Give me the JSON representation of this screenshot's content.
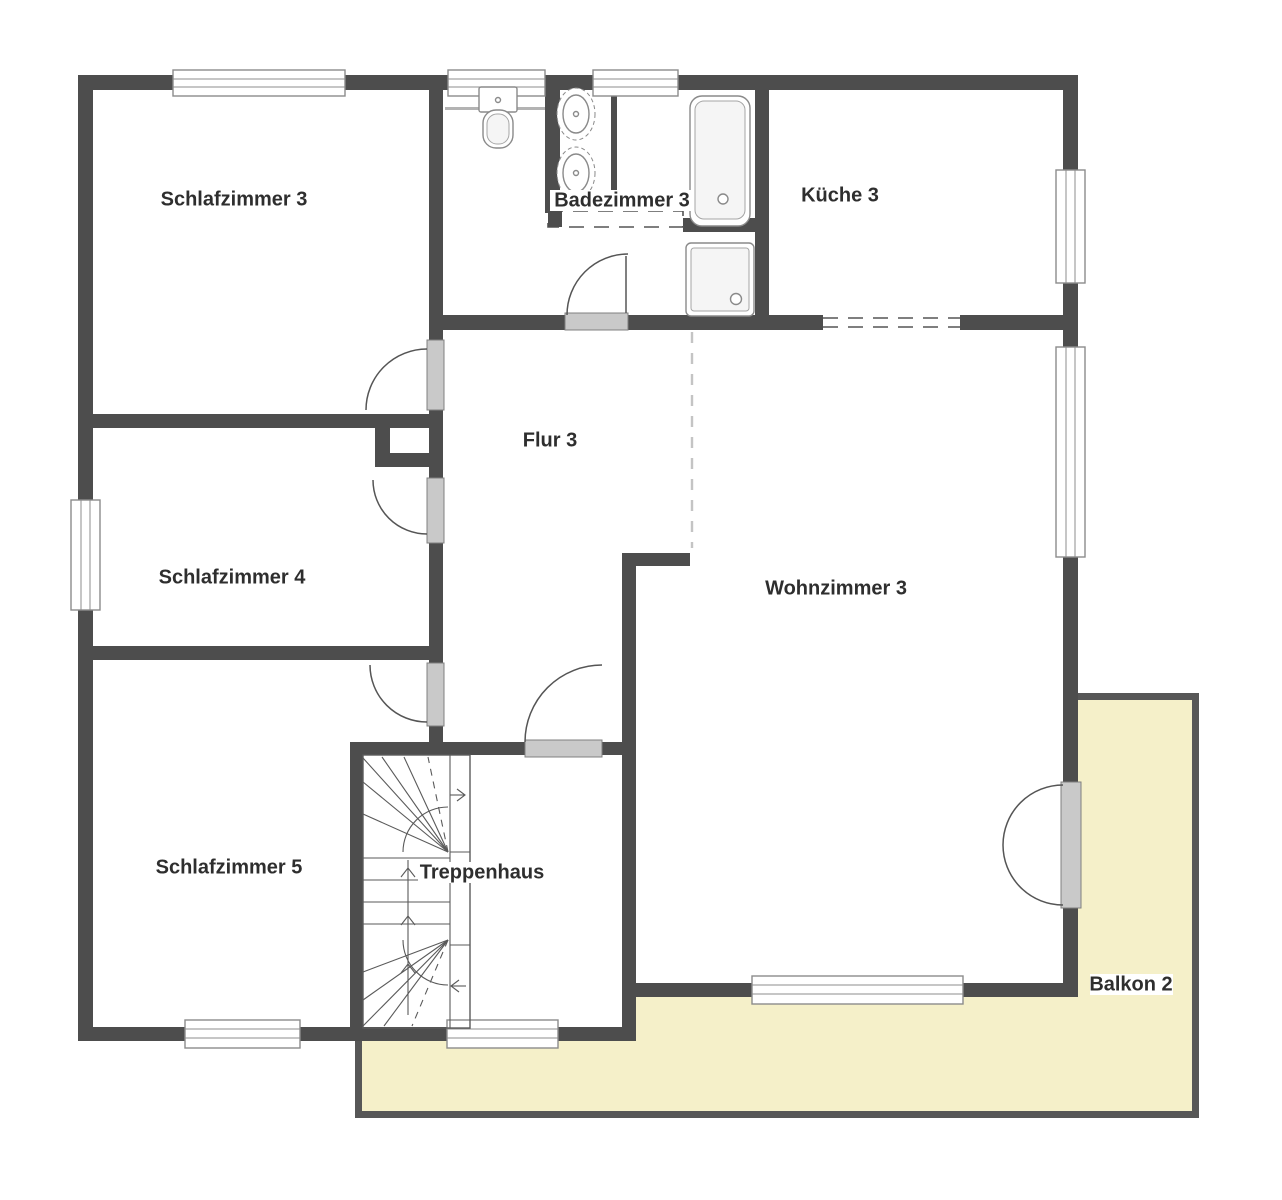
{
  "rooms": [
    {
      "id": "schlafzimmer3",
      "label": "Schlafzimmer 3"
    },
    {
      "id": "badezimmer3",
      "label": "Badezimmer 3"
    },
    {
      "id": "kueche3",
      "label": "Küche 3"
    },
    {
      "id": "flur3",
      "label": "Flur 3"
    },
    {
      "id": "schlafzimmer4",
      "label": "Schlafzimmer 4"
    },
    {
      "id": "wohnzimmer3",
      "label": "Wohnzimmer 3"
    },
    {
      "id": "schlafzimmer5",
      "label": "Schlafzimmer 5"
    },
    {
      "id": "treppenhaus",
      "label": "Treppenhaus"
    },
    {
      "id": "balkon2",
      "label": "Balkon 2"
    }
  ],
  "colors": {
    "background": "#ffffff",
    "wall": "#4d4d4d",
    "balcony_fill": "#f5f0c9",
    "balcony_wall": "#575757",
    "door_leaf": "#c9c9c9",
    "door_leaf_border": "#808080",
    "window_frame": "#8c8c8c",
    "fixture_stroke": "#8a8a8a",
    "dashed_line": "#c4c4c4",
    "arc": "#555555",
    "text": "#2e2e2e"
  }
}
